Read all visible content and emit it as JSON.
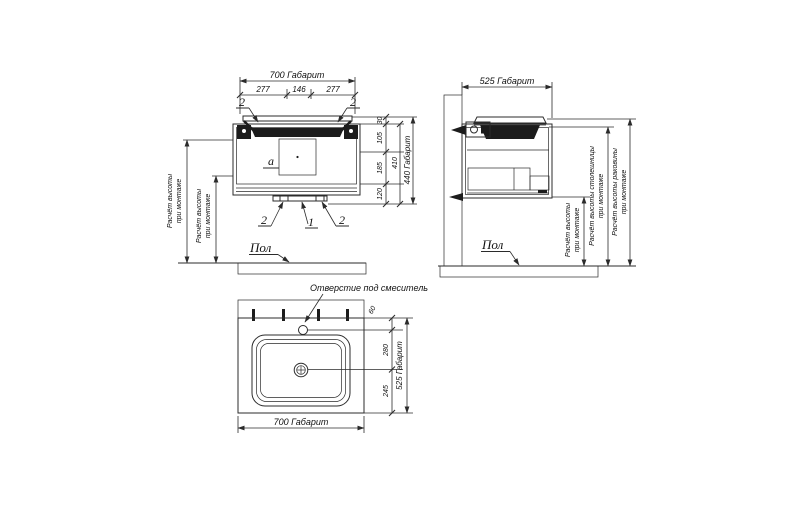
{
  "front": {
    "dim_width_total": "700 Габарит",
    "dim_w1": "277",
    "dim_w2": "146",
    "dim_w3": "277",
    "dim_h1": "30",
    "dim_h2": "105",
    "dim_h3": "185",
    "dim_h4": "120",
    "dim_h_sub": "410",
    "dim_height_total": "440 Габарит",
    "callout_top_left": "2",
    "callout_top_right": "2",
    "callout_bottom_left": "2",
    "callout_bottom_center": "1",
    "callout_bottom_right": "2",
    "area_label": "а",
    "mount1_line1": "Расчёт высоты",
    "mount1_line2": "при монтаже",
    "mount2_line1": "Расчёт высоты",
    "mount2_line2": "при монтаже",
    "floor_label": "Пол"
  },
  "side": {
    "dim_depth_total": "525 Габарит",
    "mount_line1": "Расчёт высоты",
    "mount_line2": "при монтаже",
    "counter_line1": "Расчёт высоты столешницы",
    "counter_line2": "при монтаже",
    "basin_line1": "Расчёт высоты раковины",
    "basin_line2": "при монтаже",
    "floor_label": "Пол"
  },
  "top": {
    "faucet_label": "Отверстие под смеситель",
    "dim_d1": "60",
    "dim_d2": "280",
    "dim_d3": "245",
    "dim_depth_total": "525 Габарит",
    "dim_width_total": "700 Габарит"
  }
}
